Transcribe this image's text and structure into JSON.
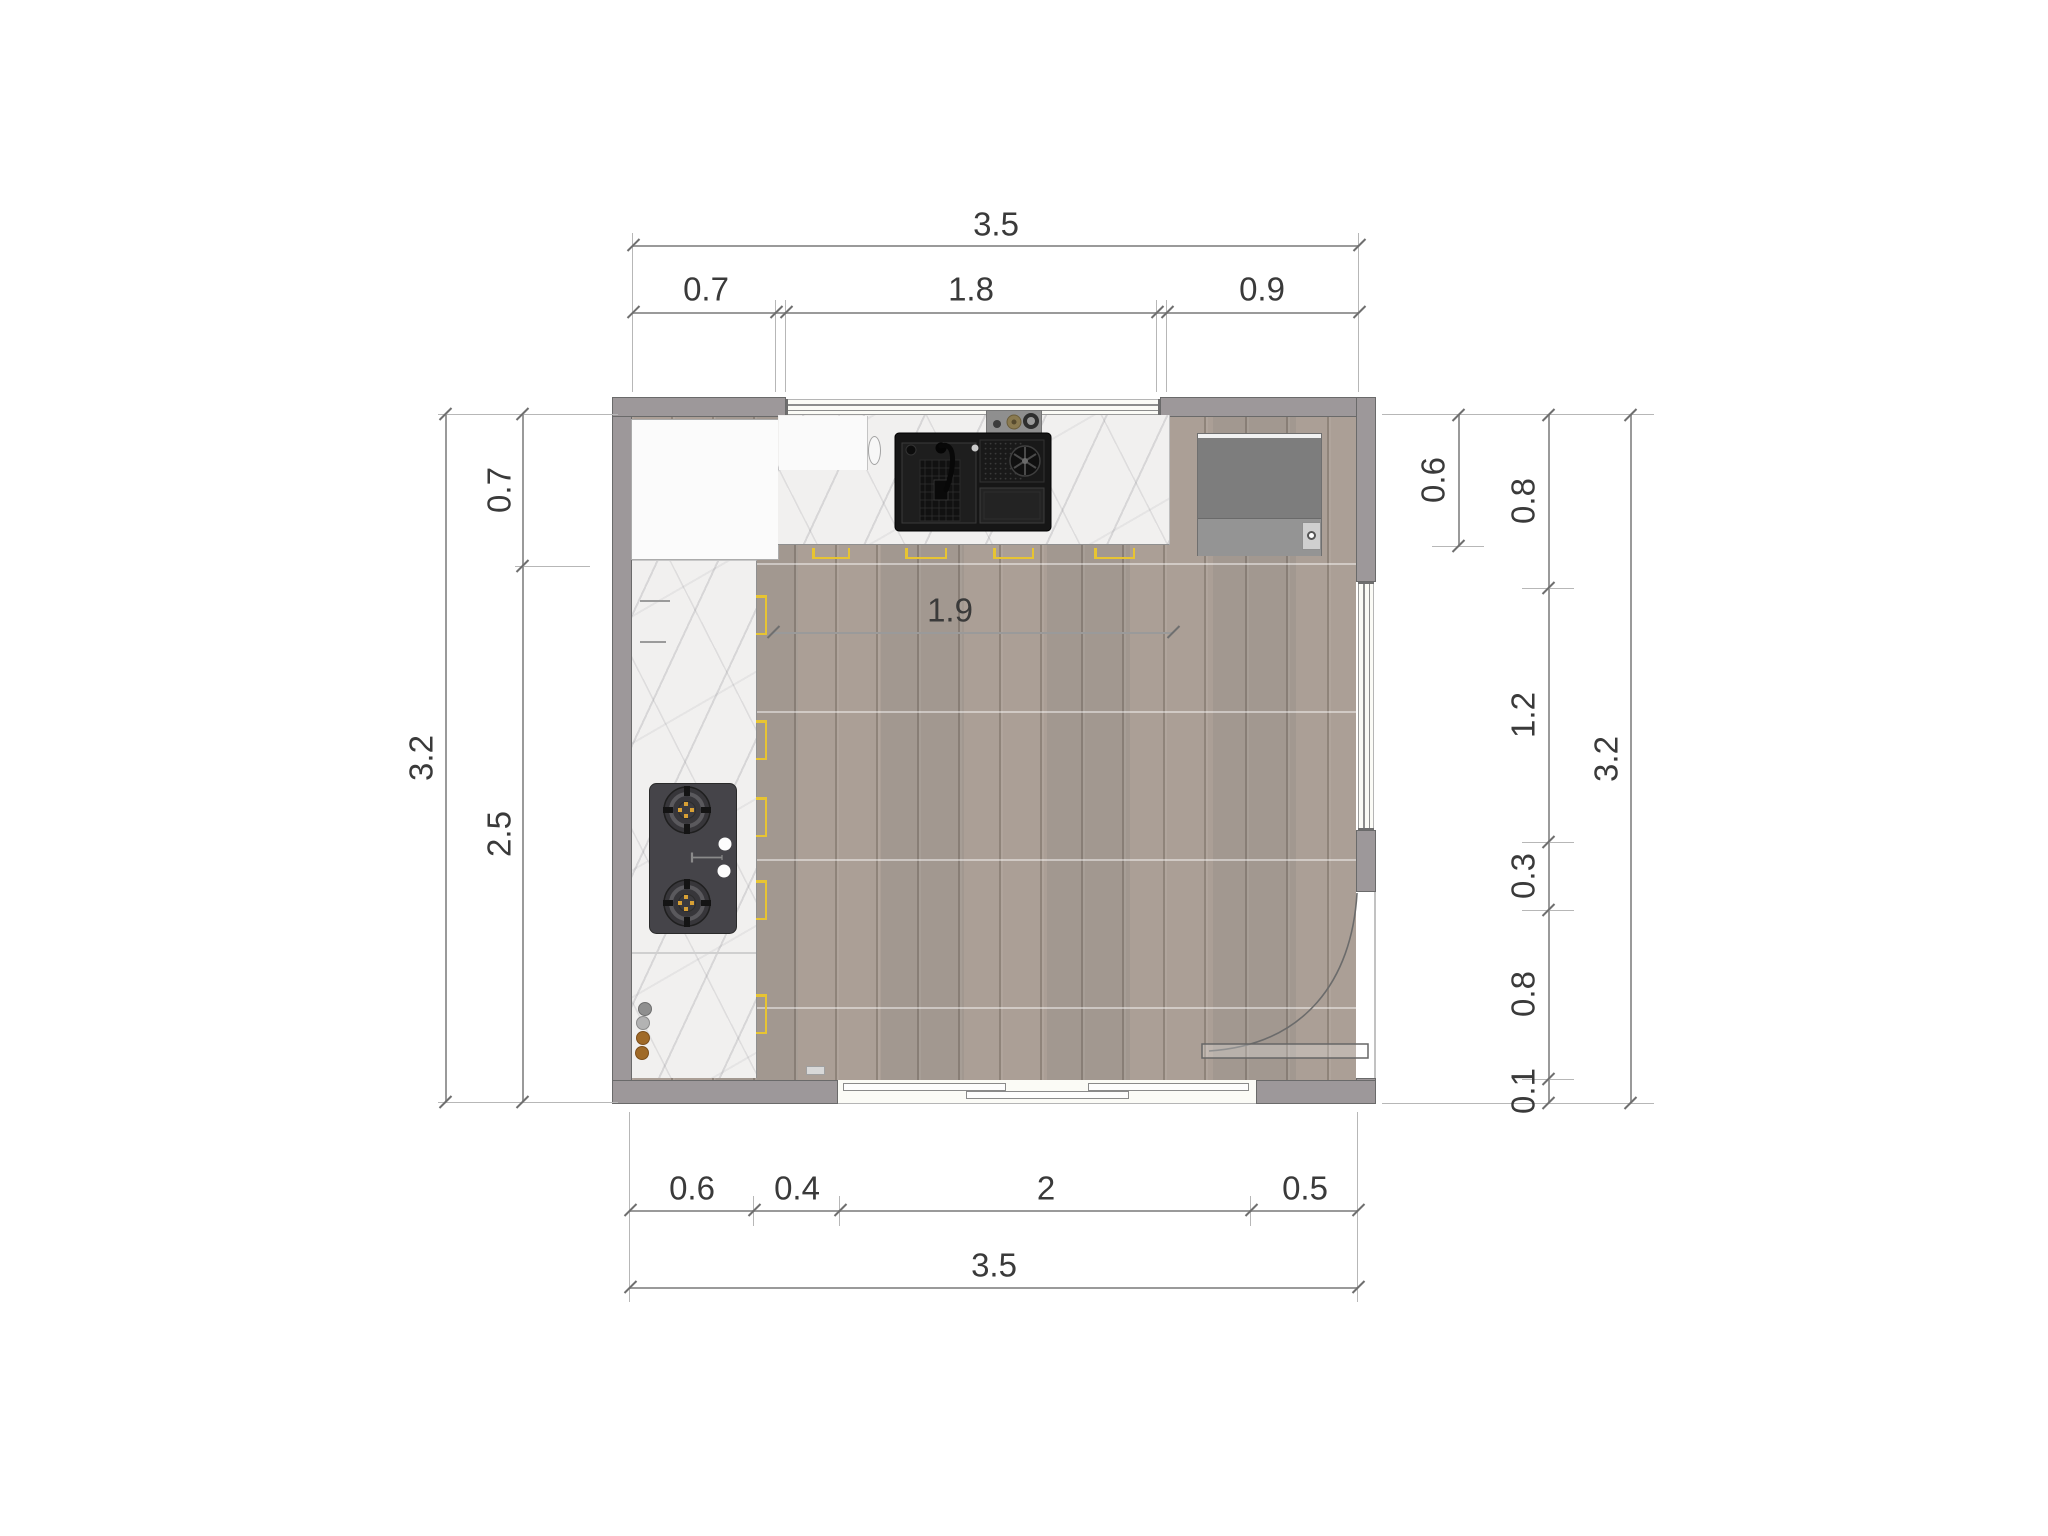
{
  "drawing": {
    "title": "kitchen floor plan (top view)",
    "units": "m"
  },
  "dims": {
    "top": {
      "total": "3.5",
      "seg": [
        "0.7",
        "1.8",
        "0.9"
      ]
    },
    "left": {
      "total": "3.2",
      "seg": [
        "0.7",
        "2.5"
      ]
    },
    "right": {
      "appliance_depth": "0.6",
      "seg": [
        "0.8",
        "1.2",
        "0.3",
        "0.8",
        "0.1"
      ],
      "total": "3.2"
    },
    "bottom": {
      "seg": [
        "0.6",
        "0.4",
        "2",
        "0.5"
      ],
      "total": "3.5"
    },
    "interior": {
      "counter_run": "1.9"
    }
  },
  "fixtures": {
    "sink": "double-basin black kitchen sink with faucet and disposal",
    "hob": "2-burner gas hob with white knobs",
    "appliance": "refrigerator / tall appliance",
    "cabinet": "tall white cabinet",
    "counter_top": "marble countertop (top run)",
    "counter_left": "marble countertop (left run)",
    "jars": "counter jars (2 steel, 2 bronze)",
    "door": "hinged door with 90° swing arc (right wall)",
    "window_top": "window in top wall",
    "window_right": "window in right wall",
    "slider_bottom": "3-panel sliding door in bottom wall",
    "hinge_marks": "yellow cabinet door-front symbols"
  },
  "colors": {
    "wall": "#9d989a",
    "wall_edge": "#6a6a6a",
    "floor_wood": "#a79c93",
    "marble": "#f1f0ef",
    "stove_body": "#454449",
    "burner_accent": "#d8a035",
    "appliance_gray": "#7d7d7d",
    "symbol_yellow": "#e7c432",
    "dimension_line": "#9a9a9a",
    "dimension_text": "#3a3a3a",
    "sink_black": "#161616"
  }
}
